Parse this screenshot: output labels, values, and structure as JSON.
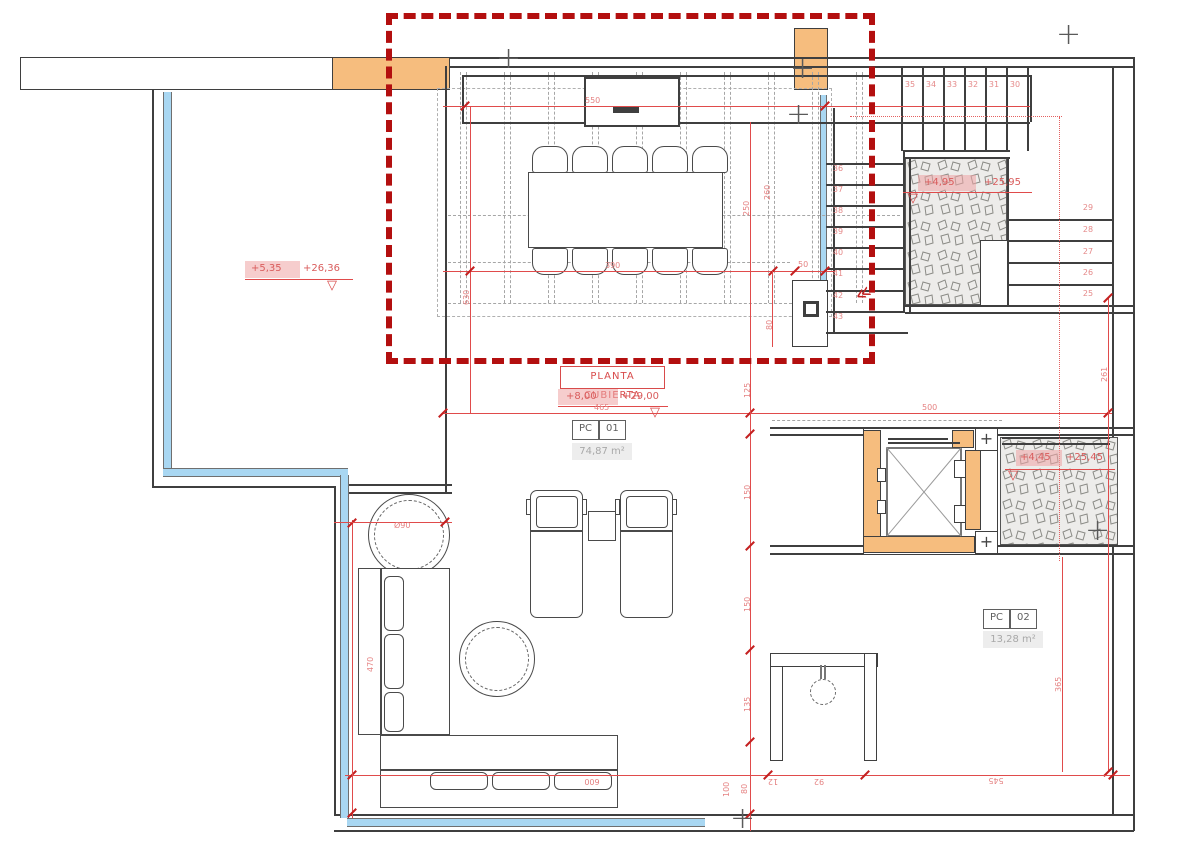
{
  "drawing": {
    "title": "PLANTA CUBIERTA",
    "levels": {
      "roof_terrace": {
        "relative": "+8,00",
        "absolute": "+29,00"
      },
      "lower_roof": {
        "relative": "+5,35",
        "absolute": "+26,36"
      },
      "stair_mid_landing": {
        "relative": "+4,95",
        "absolute": "+25,95"
      },
      "stair_low_landing": {
        "relative": "+4,45",
        "absolute": "+25,45"
      }
    },
    "rooms": [
      {
        "code": "PC",
        "number": "01",
        "area": "74,87 m²"
      },
      {
        "code": "PC",
        "number": "02",
        "area": "13,28 m²"
      }
    ],
    "stair_treads": {
      "top_run": [
        "35",
        "34",
        "33",
        "32",
        "31",
        "30"
      ],
      "left_run": [
        "36",
        "37",
        "38",
        "39",
        "40",
        "41",
        "42",
        "43"
      ],
      "right_run": [
        "29",
        "28",
        "27",
        "26",
        "25"
      ]
    },
    "dimensions": {
      "d550": "550",
      "d390": "390",
      "d90": "Ø90",
      "d630": "630",
      "d50": "50",
      "d80a": "80",
      "d250": "250",
      "d260": "260",
      "d125": "125",
      "d465": "465",
      "d500": "500",
      "d261": "261",
      "d150a": "150",
      "d150b": "150",
      "d135": "135",
      "d100": "100",
      "d600": "600",
      "d80b": "80",
      "d12": "12",
      "d92": "92",
      "d545": "545",
      "d365": "365",
      "d470": "470"
    },
    "glyphs": {
      "level_marker": "▽",
      "stair_direction": "≪",
      "survey_cross": "+"
    },
    "colors": {
      "selection_red": "#b30f0f",
      "annotation_red": "#e04b4b",
      "wall_black": "#3f3f3f",
      "structure_orange": "#f6bd7e",
      "pool_blue": "#a9d7f2",
      "hatch_gray": "#edecea"
    }
  }
}
